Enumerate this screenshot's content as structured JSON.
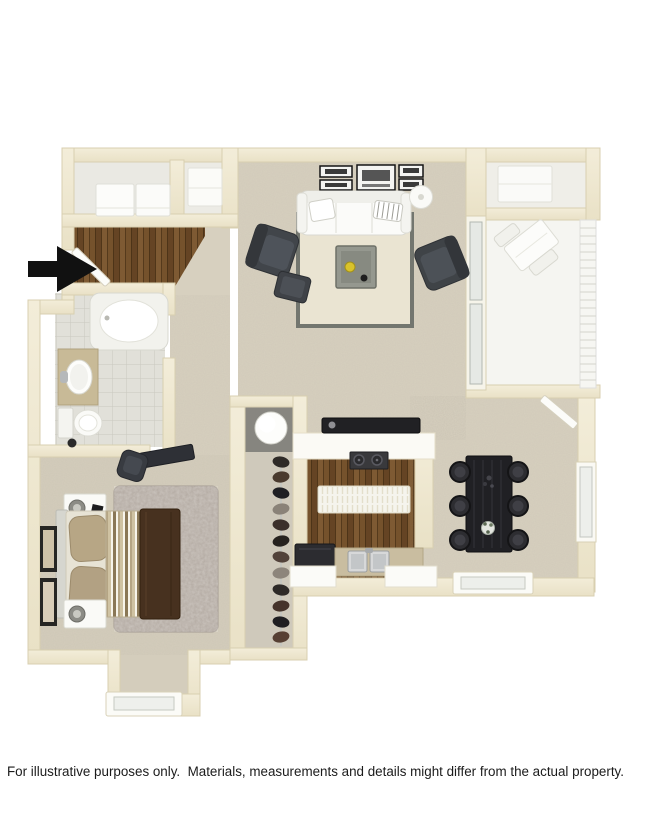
{
  "window": {
    "width": 650,
    "height": 828,
    "background": "#ffffff"
  },
  "floor_plan": {
    "kind": "3d-apartment-floor-plan-top-view",
    "entry": {
      "icon": "entry-arrow",
      "direction": "right"
    },
    "colors": {
      "wall": "#efe8d1",
      "wall_edge": "#d8cfb0",
      "carpet": "#d7d0bf",
      "hardwood": "#6e4c28",
      "tile": "#e1e0d9",
      "balcony_floor": "#f5f5f1",
      "furniture_dark": "#3f4247",
      "dining_table": "#202024",
      "bed_throw": "#47311f",
      "accent_yellow": "#d9c22b",
      "entry_arrow": "#111111"
    },
    "rooms": [
      {
        "name": "living-room",
        "floor": "carpet",
        "furniture": [
          "sofa",
          "two-armchairs",
          "ottoman",
          "coffee-table",
          "area-rug",
          "floor-lamp",
          "wall-media-units"
        ]
      },
      {
        "name": "balcony",
        "floor": "light-concrete",
        "furniture": [
          "patio-table-and-chairs",
          "railing",
          "storage-closet",
          "sliding-glass-door",
          "balcony-door"
        ]
      },
      {
        "name": "kitchen",
        "floor": "hardwood",
        "furniture": [
          "breakfast-bar",
          "cooktop",
          "island",
          "refrigerator",
          "double-sink",
          "cabinets"
        ]
      },
      {
        "name": "dining-area",
        "floor": "carpet",
        "furniture": [
          "dining-table",
          "six-chairs",
          "side-window",
          "bottom-window"
        ]
      },
      {
        "name": "bedroom",
        "floor": "carpet",
        "furniture": [
          "bed",
          "two-nightstands",
          "table-lamps",
          "desk",
          "desk-chair",
          "shag-rug",
          "wall-art",
          "bay-window"
        ]
      },
      {
        "name": "bathroom",
        "floor": "tile",
        "furniture": [
          "bathtub",
          "vanity-sink",
          "toilet"
        ]
      },
      {
        "name": "walk-in-closet",
        "floor": "carpet",
        "furniture": [
          "hanging-clothes",
          "closet-rod"
        ]
      },
      {
        "name": "utility-closet",
        "floor": "concrete",
        "furniture": [
          "water-heater"
        ]
      },
      {
        "name": "laundry-closet",
        "floor": "vinyl",
        "furniture": [
          "washer",
          "dryer"
        ]
      },
      {
        "name": "entry",
        "floor": "hardwood",
        "furniture": [
          "front-door"
        ]
      }
    ]
  },
  "footer": {
    "disclaimer": "For illustrative purposes only.  Materials, measurements and details might differ from the actual property."
  }
}
